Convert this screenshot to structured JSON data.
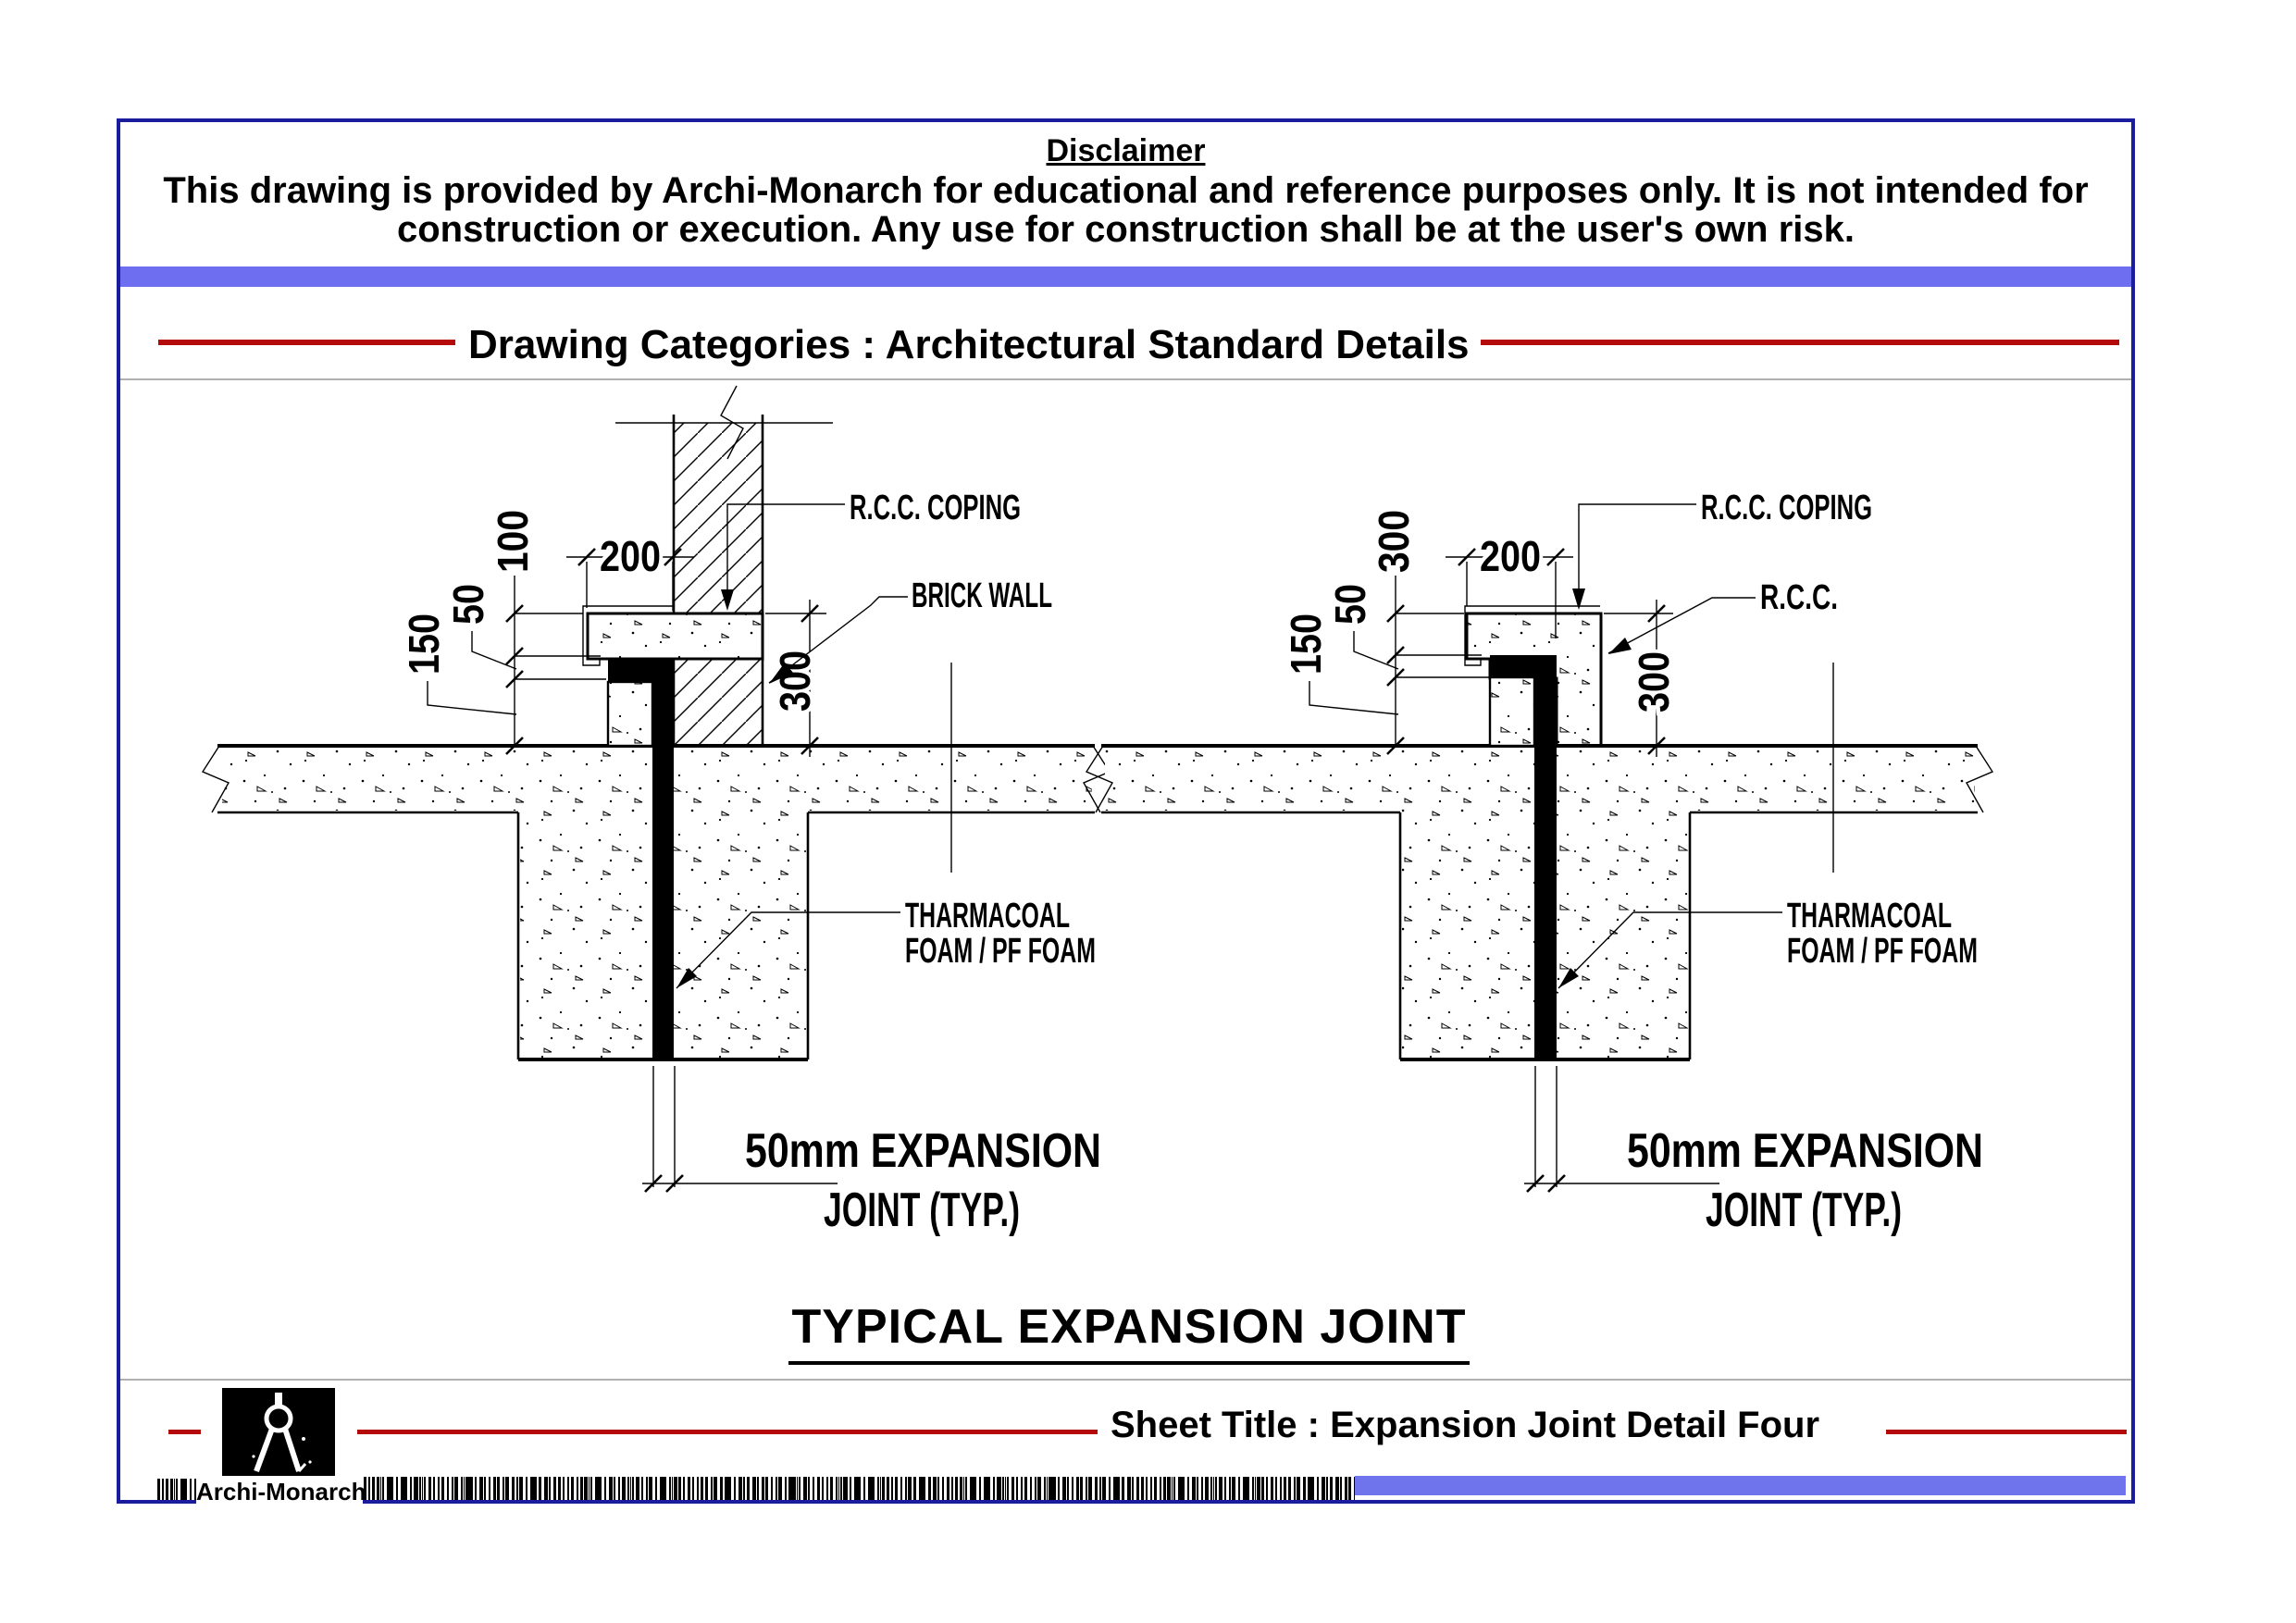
{
  "colors": {
    "frame": "#1b1b9e",
    "accent_red": "#b40a0a",
    "top_bar": "#6d6ff0",
    "bottom_bar": "#7074ec"
  },
  "disclaimer": {
    "title": "Disclaimer",
    "line1": "This drawing is provided by Archi-Monarch for educational and reference purposes only. It is not intended for",
    "line2": "construction or execution. Any use for construction shall be at the user's own risk."
  },
  "category_header": {
    "label": "Drawing Categories : Architectural Standard Details"
  },
  "main_title": {
    "label": "TYPICAL EXPANSION JOINT"
  },
  "sheet": {
    "brand": "Archi-Monarch",
    "title": "Sheet Title : Expansion Joint Detail Four"
  },
  "drawings": {
    "left": {
      "labels": {
        "coping": "R.C.C. COPING",
        "wall": "BRICK WALL",
        "foam1": "THARMACOAL",
        "foam2": "FOAM / PF FOAM",
        "joint1": "50mm EXPANSION",
        "joint2": "JOINT (TYP.)"
      },
      "dims": {
        "d100": "100",
        "d50": "50",
        "d150": "150",
        "d200": "200",
        "d300": "300"
      }
    },
    "right": {
      "labels": {
        "coping": "R.C.C. COPING",
        "wall": "R.C.C.",
        "foam1": "THARMACOAL",
        "foam2": "FOAM / PF FOAM",
        "joint1": "50mm EXPANSION",
        "joint2": "JOINT (TYP.)"
      },
      "dims": {
        "d300top": "300",
        "d50": "50",
        "d150": "150",
        "d200": "200",
        "d300": "300"
      }
    }
  }
}
